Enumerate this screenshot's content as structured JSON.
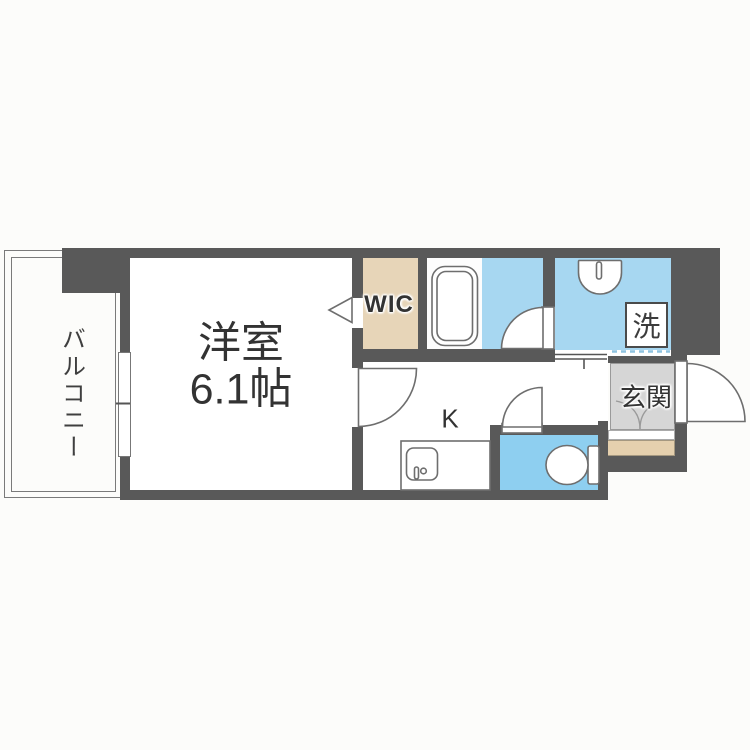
{
  "plan": {
    "balcony": {
      "label": "バルコニー"
    },
    "main_room": {
      "label": "洋室",
      "size": "6.1帖"
    },
    "wic": {
      "label": "WIC"
    },
    "kitchen": {
      "label": "K"
    },
    "laundry": {
      "label": "洗"
    },
    "entrance": {
      "label": "玄関"
    },
    "colors": {
      "wall_gray": "#595959",
      "water_area_blue": "#a7d7f1",
      "toilet_blue": "#8ecff0",
      "wic_beige": "#e7d5b8",
      "entrance_step_beige": "#e5d0ae",
      "entrance_floor_gray": "#d6d6d6",
      "fixture_outline": "#6e6e6e",
      "boundary_dash_blue": "#8fc3e0",
      "text": "#333333"
    }
  }
}
